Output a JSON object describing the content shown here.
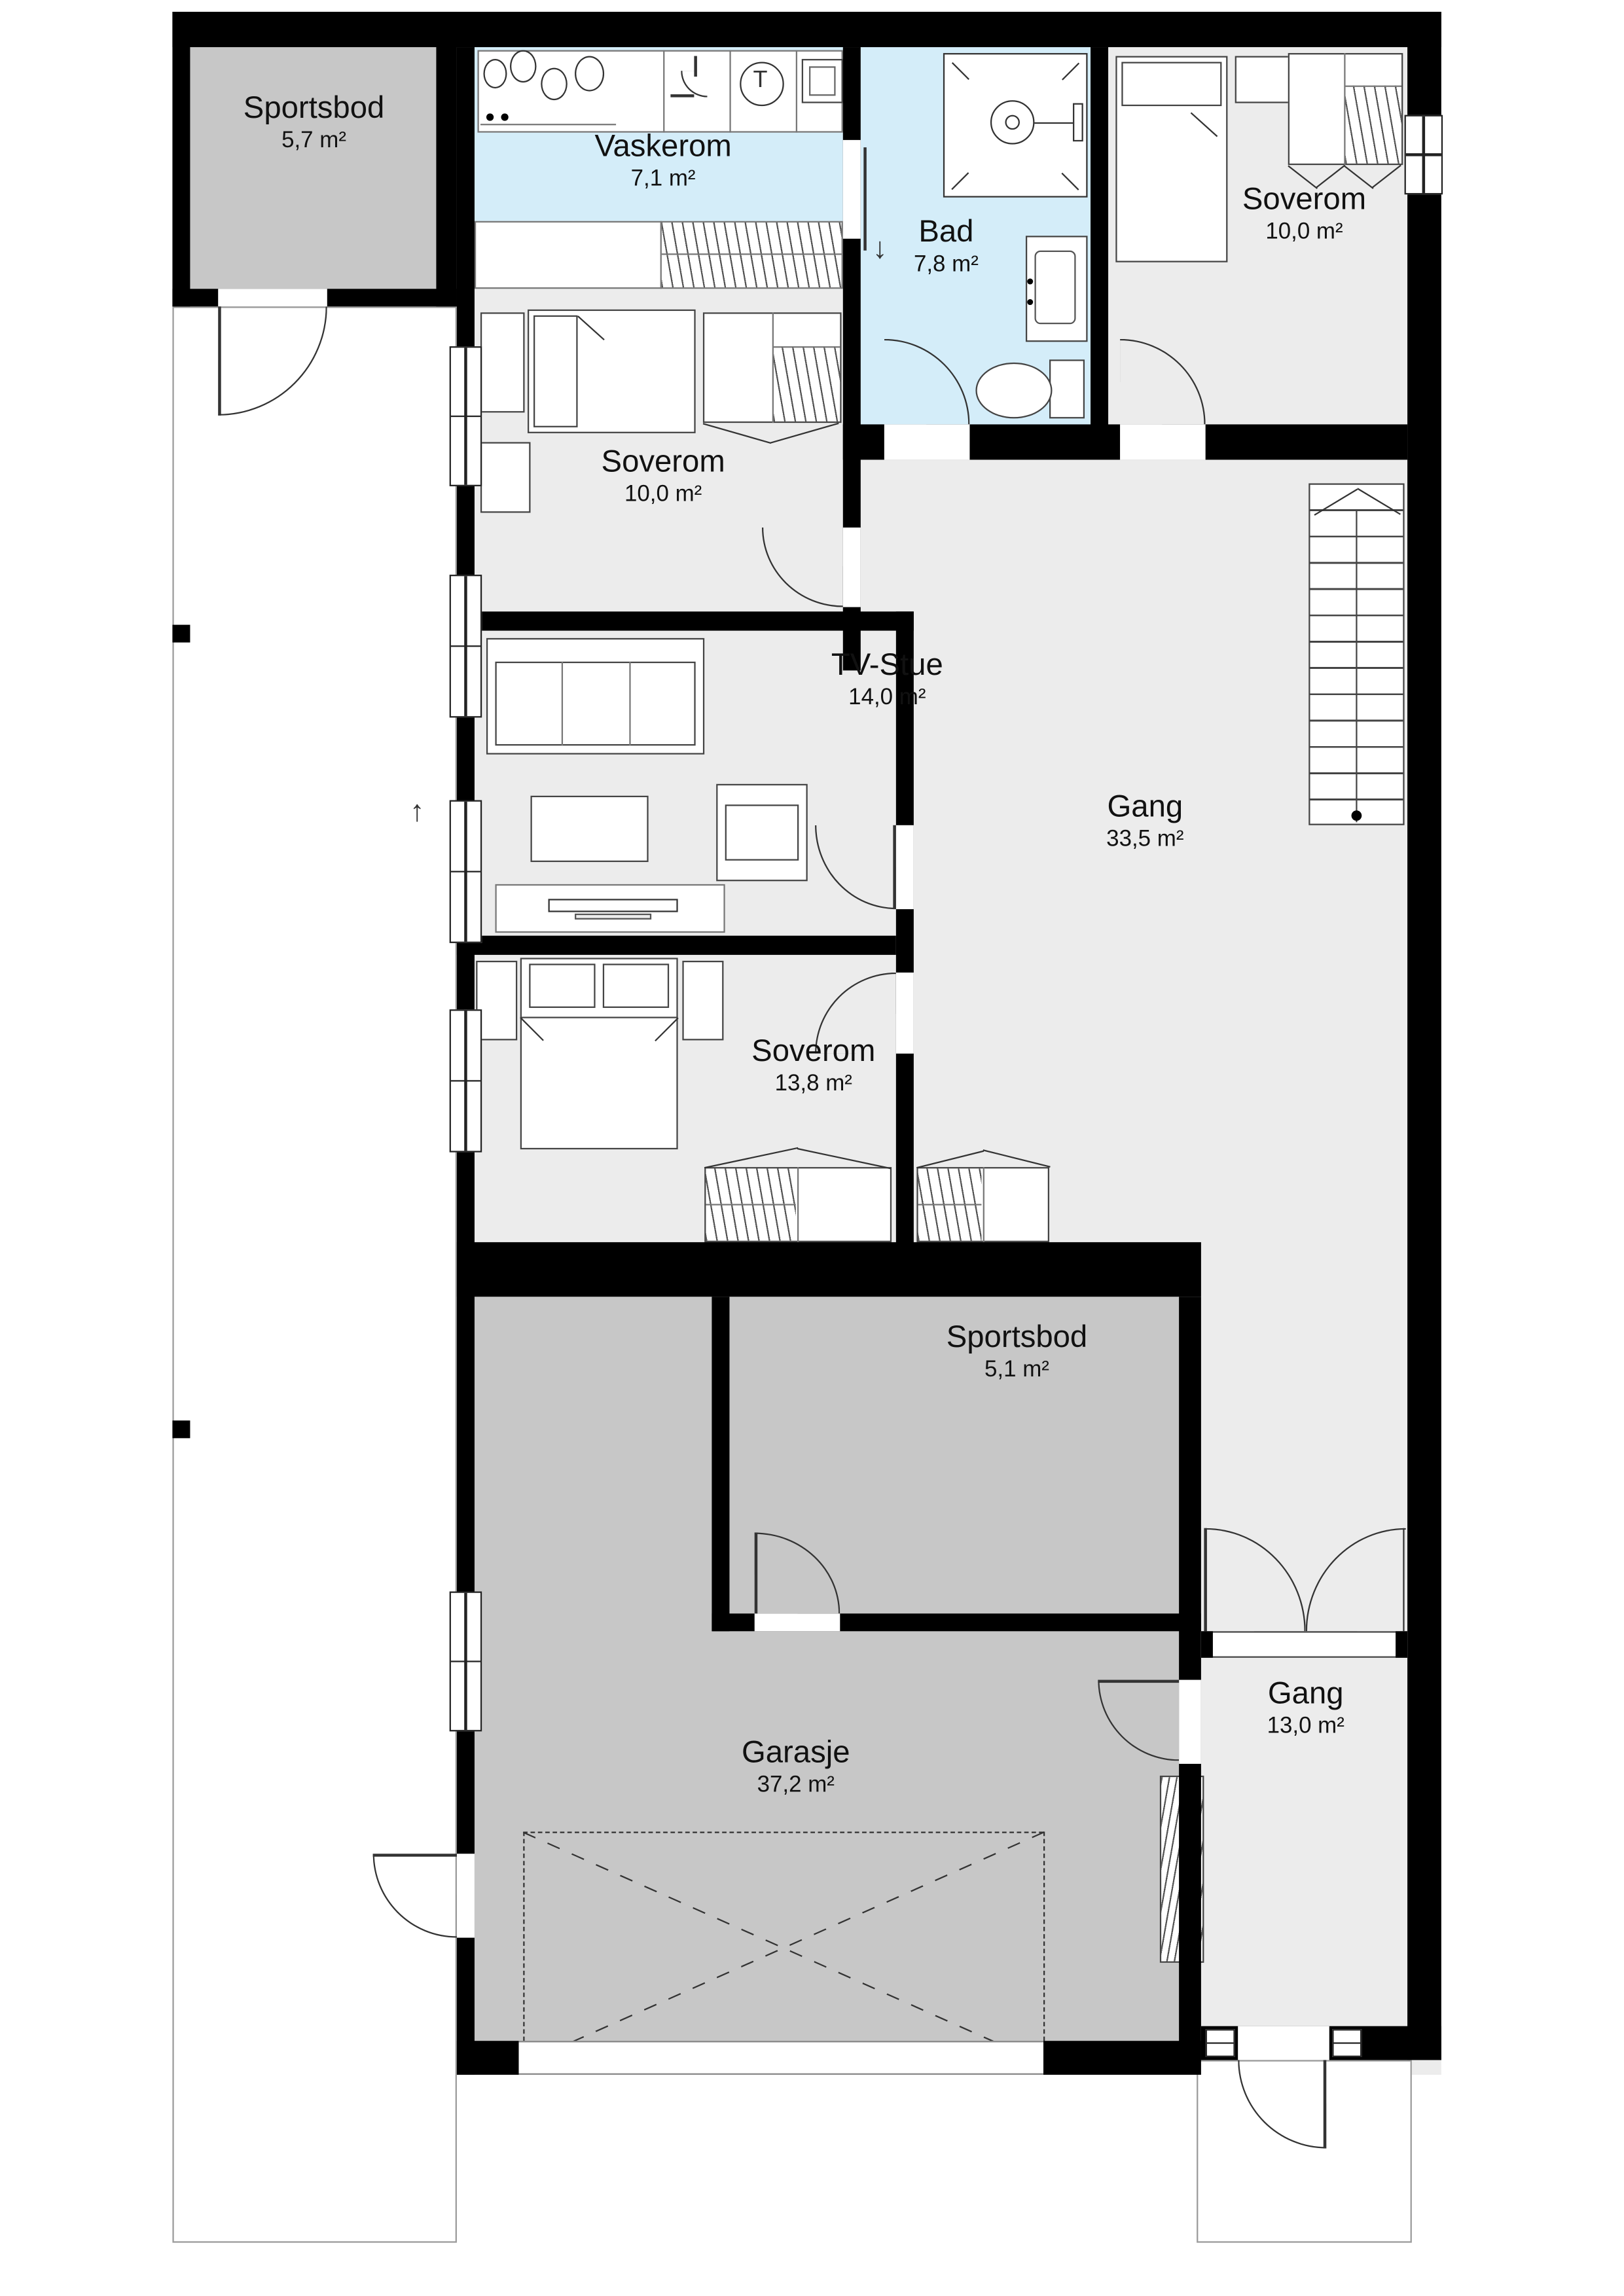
{
  "rooms": {
    "sportsbod_nw": {
      "name": "Sportsbod",
      "area": "5,7 m²"
    },
    "vaskerom": {
      "name": "Vaskerom",
      "area": "7,1 m²"
    },
    "bad": {
      "name": "Bad",
      "area": "7,8 m²"
    },
    "soverom_ne": {
      "name": "Soverom",
      "area": "10,0 m²"
    },
    "soverom_vest": {
      "name": "Soverom",
      "area": "10,0 m²"
    },
    "tv_stue": {
      "name": "TV-Stue",
      "area": "14,0 m²"
    },
    "gang": {
      "name": "Gang",
      "area": "33,5 m²"
    },
    "soverom_sor": {
      "name": "Soverom",
      "area": "13,8 m²"
    },
    "sportsbod_garasje": {
      "name": "Sportsbod",
      "area": "5,1 m²"
    },
    "garasje": {
      "name": "Garasje",
      "area": "37,2 m²"
    },
    "gang_entre": {
      "name": "Gang",
      "area": "13,0 m²"
    }
  },
  "icons": {
    "dryer_symbol": "T",
    "drain_arrow_down": "↓",
    "carport_arrow_up": "↑"
  },
  "colors": {
    "wall": "#000000",
    "interior_floor": "#ececec",
    "storage_floor": "#c7c7c7",
    "wet_room_floor": "#d4edf9",
    "furniture_line": "#444444"
  }
}
